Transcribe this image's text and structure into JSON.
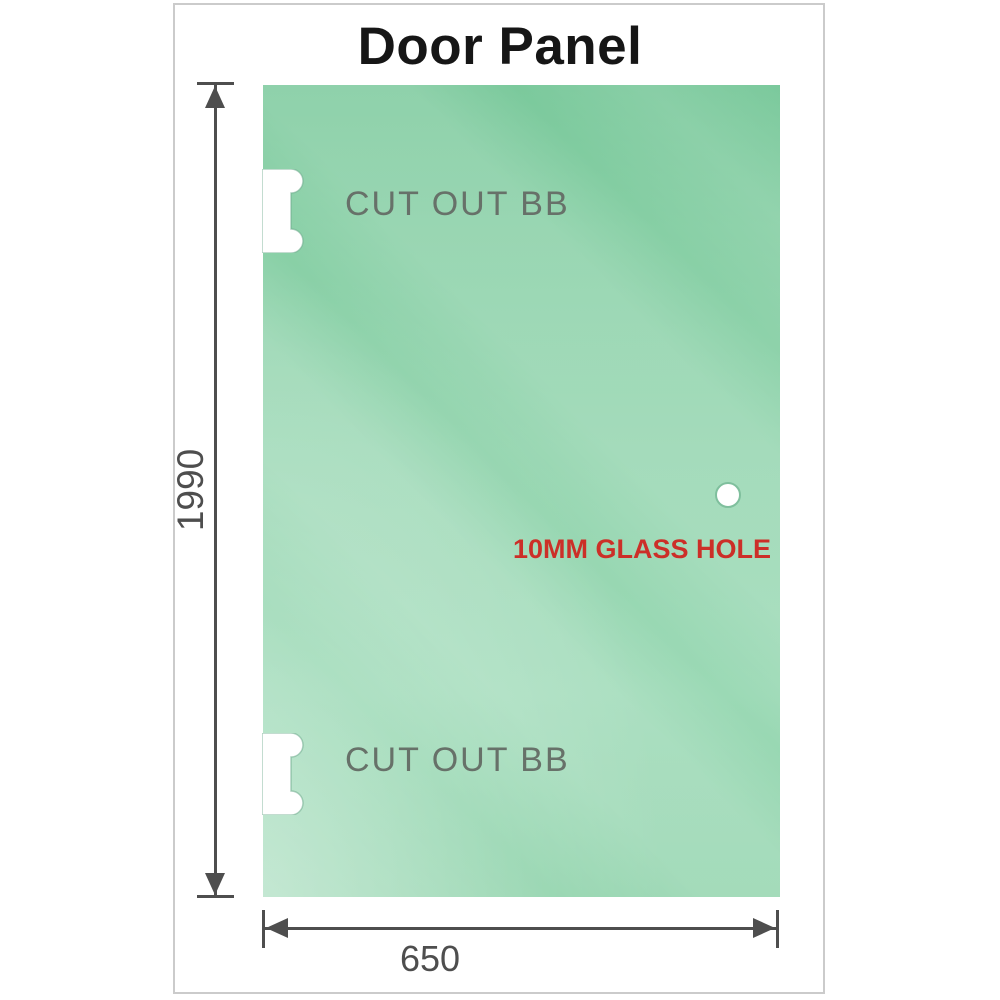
{
  "title": "Door Panel",
  "panel": {
    "cutout_top": {
      "label": "CUT OUT BB"
    },
    "cutout_bottom": {
      "label": "CUT OUT BB"
    },
    "glass_hole": {
      "label": "10MM GLASS HOLE"
    }
  },
  "dimensions": {
    "height": {
      "value": "1990"
    },
    "width": {
      "value": "650"
    }
  },
  "colors": {
    "glass_green_top": "#7bc99c",
    "glass_green_bottom": "#92d4ad",
    "dimension_gray": "#4e4e4e",
    "cutout_label_gray": "#677169",
    "hole_label_red": "#cc2f28",
    "title_black": "#161616",
    "card_border_gray": "#cbcbcb",
    "hole_ring_green": "#7fbf9d"
  }
}
